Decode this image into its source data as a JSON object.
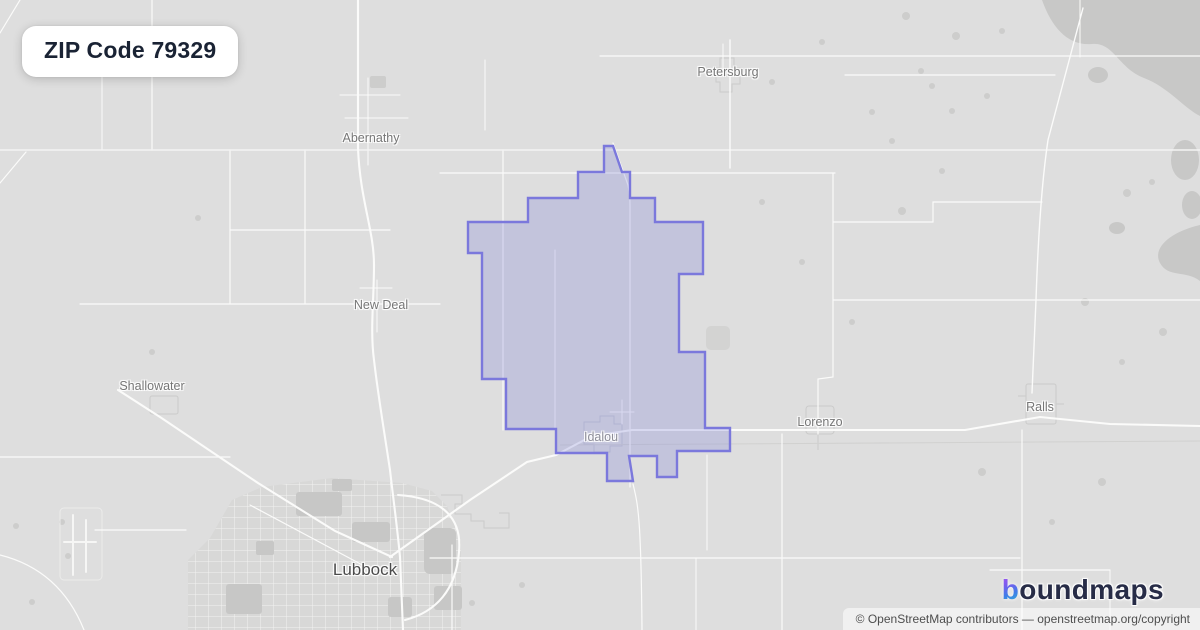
{
  "badge": {
    "title": "ZIP Code 79329"
  },
  "map": {
    "labels": {
      "petersburg": "Petersburg",
      "abernathy": "Abernathy",
      "new_deal": "New Deal",
      "shallowater": "Shallowater",
      "idalou": "Idalou",
      "lorenzo": "Lorenzo",
      "ralls": "Ralls",
      "lubbock": "Lubbock"
    },
    "zip_boundary": {
      "zip": "79329",
      "stroke_color": "#7b78dc",
      "fill_color": "rgba(124,130,216,0.28)"
    }
  },
  "logo": {
    "first_letter": "b",
    "rest": "oundmaps",
    "text_color": "#272c47",
    "gradient_top": "#a455f2",
    "gradient_bottom": "#2cb4d4"
  },
  "attribution": {
    "text": "© OpenStreetMap contributors — openstreetmap.org/copyright"
  },
  "colors": {
    "map_background": "#dedede",
    "road": "#fbfbfa",
    "landuse_patch": "#cdcdcc",
    "label_text": "#767676",
    "badge_text": "#1a2334"
  }
}
